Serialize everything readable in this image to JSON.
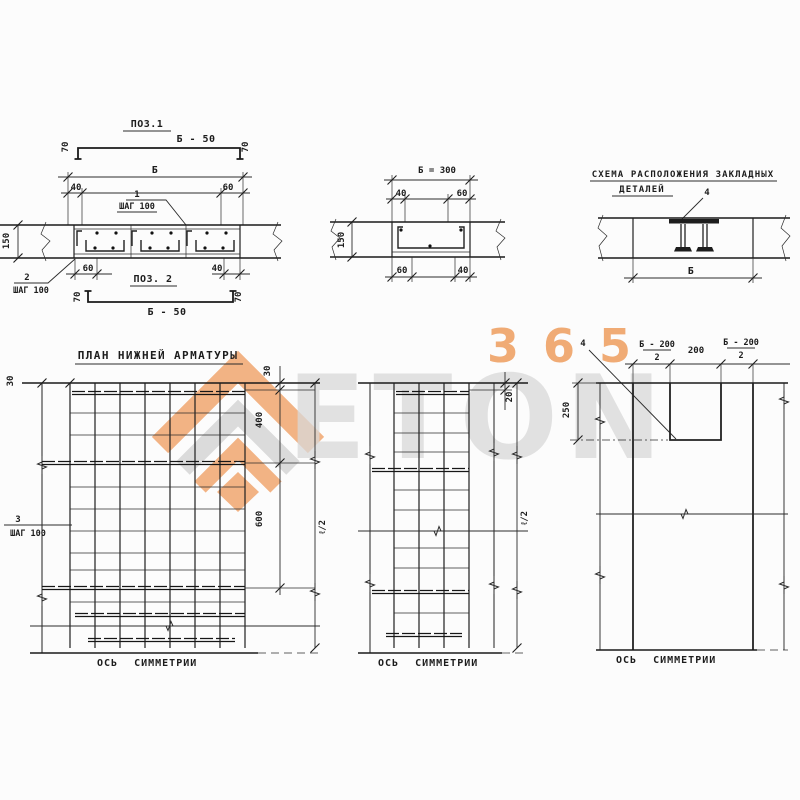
{
  "watermark": {
    "number": "365",
    "name": "ETON",
    "orange": "#ee9d5e",
    "gray": "#d9d9d9"
  },
  "pos1": {
    "title": "ПОЗ.1",
    "bar_label": "Б - 50",
    "hook_left": "70",
    "hook_right": "70"
  },
  "section_left": {
    "dim_width": "Б",
    "dim_top_left": "40",
    "dim_top_right": "60",
    "callout_top_num": "1",
    "callout_top_step": "ШАГ 100",
    "dim_height": "150",
    "callout_bottom_num": "2",
    "callout_bottom_step": "ШАГ 100",
    "dim_bottom_left": "60",
    "dim_bottom_right": "40"
  },
  "pos2": {
    "title": "ПОЗ. 2",
    "bar_label": "Б - 50",
    "hook_left": "70",
    "hook_right": "70"
  },
  "section_mid": {
    "dim_width": "Б = 300",
    "dim_top_left": "40",
    "dim_top_right": "60",
    "dim_height": "150",
    "dim_bottom_left": "60",
    "dim_bottom_right": "40"
  },
  "schema": {
    "title_line1": "СХЕМА РАСПОЛОЖЕНИЯ ЗАКЛАДНЫХ",
    "title_line2": "ДЕТАЛЕЙ",
    "callout": "4",
    "dim_width": "Б"
  },
  "plan_left": {
    "title": "ПЛАН НИЖНЕЙ АРМАТУРЫ",
    "dim_corner": "30",
    "dim_top": "30",
    "dim_400": "400",
    "dim_600": "600",
    "dim_half": "ℓ/2",
    "callout_num": "3",
    "callout_step": "ШАГ 100",
    "axis_label": "ОСЬ СИММЕТРИИ"
  },
  "plan_mid": {
    "dim_top": "20",
    "dim_half": "ℓ/2",
    "axis_label": "ОСЬ СИММЕТРИИ"
  },
  "plan_right": {
    "callout": "4",
    "frac_left_num": "Б - 200",
    "frac_left_den": "2",
    "dim_center": "200",
    "frac_right_num": "Б - 200",
    "frac_right_den": "2",
    "dim_height": "250",
    "axis_label": "ОСЬ СИММЕТРИИ"
  }
}
